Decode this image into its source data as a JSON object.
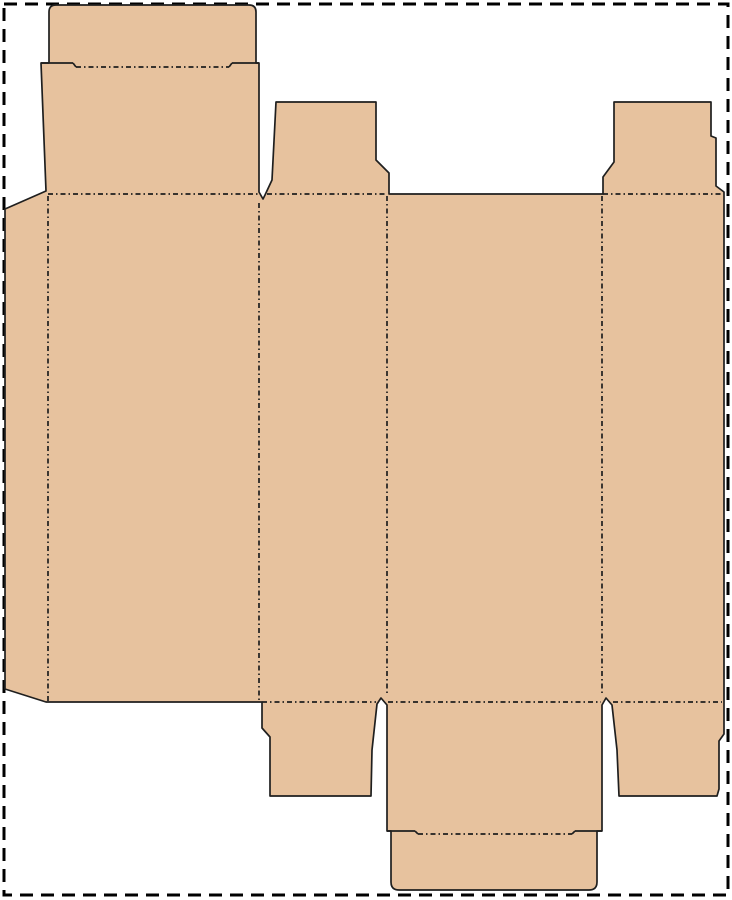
{
  "page": {
    "width": 732,
    "height": 900,
    "background": "#ffffff"
  },
  "diagram": {
    "type": "packaging-dieline",
    "description": "Flat die-cut template (dieline) of a reverse tuck-end carton: four body panels with glue flap, top lid with tuck flap, bottom lid with tuck flap, and four dust flaps",
    "colors": {
      "board_fill": "#e7c29e",
      "cut_line": "#1f1f1f",
      "fold_line": "#1f1f1f",
      "page_border": "#000000"
    },
    "line_styles": {
      "cut_width": 1.7,
      "fold_width": 1.7,
      "fold_dash": "5 3 1.5 3",
      "border_width": 3,
      "border_dash": "13 8"
    },
    "shapes": [
      {
        "name": "page-border",
        "tag": "rect",
        "attrs": {
          "x": 4,
          "y": 4,
          "width": 724,
          "height": 891,
          "fill": "none",
          "stroke": "#000000",
          "stroke-width": 3,
          "stroke-dasharray": "13 8"
        }
      },
      {
        "name": "carton-outline",
        "tag": "path",
        "attrs": {
          "d": "M 49 12 Q 49 5 56 5 L 249 5 Q 256 5 256 12 L 256 63 L 259 63 L 259 192 L 263 199 L 265 195 L 272 180 L 276 102 L 376 102 L 376 160 L 389 173 L 389 194 L 602 194 L 603 194 L 603 177 L 614 162 L 614 102 L 711 102 L 711 136 L 716 138 L 716 186 L 724 192 L 724 734 L 719 741 L 719 789 L 717 796 L 619 796 L 617 750 L 612 705 L 606 698 L 602 705 L 602 831 L 597 831 L 597 882 Q 597 890 589 890 L 399 890 Q 391 890 391 882 L 391 831 L 387 831 L 387 705 L 381 698 L 377 704 L 372 750 L 371 796 L 270 796 L 270 737 L 262 728 L 262 702 L 46 702 L 5 689 L 5 209 L 46 191 L 41 63 L 49 63 Z",
          "fill": "#e7c29e",
          "stroke": "#1f1f1f",
          "stroke-width": 1.7,
          "stroke-linejoin": "round"
        }
      },
      {
        "name": "fold-tuck-top",
        "tag": "line",
        "attrs": {
          "x1": 76,
          "y1": 67,
          "x2": 229,
          "y2": 67,
          "stroke": "#1f1f1f",
          "stroke-width": 1.7,
          "stroke-dasharray": "5 3 1.5 3"
        }
      },
      {
        "name": "fold-lid-top",
        "tag": "line",
        "attrs": {
          "x1": 48,
          "y1": 194,
          "x2": 258,
          "y2": 194,
          "stroke": "#1f1f1f",
          "stroke-width": 1.7,
          "stroke-dasharray": "5 3 1.5 3"
        }
      },
      {
        "name": "fold-dustflap-top-left",
        "tag": "line",
        "attrs": {
          "x1": 267,
          "y1": 194,
          "x2": 387,
          "y2": 194,
          "stroke": "#1f1f1f",
          "stroke-width": 1.7,
          "stroke-dasharray": "5 3 1.5 3"
        }
      },
      {
        "name": "fold-dustflap-top-right",
        "tag": "line",
        "attrs": {
          "x1": 603,
          "y1": 194,
          "x2": 722,
          "y2": 194,
          "stroke": "#1f1f1f",
          "stroke-width": 1.7,
          "stroke-dasharray": "5 3 1.5 3"
        }
      },
      {
        "name": "fold-glue-flap",
        "tag": "line",
        "attrs": {
          "x1": 48,
          "y1": 196,
          "x2": 48,
          "y2": 701,
          "stroke": "#1f1f1f",
          "stroke-width": 1.7,
          "stroke-dasharray": "5 3 1.5 3"
        }
      },
      {
        "name": "fold-panel-1-2",
        "tag": "line",
        "attrs": {
          "x1": 259,
          "y1": 203,
          "x2": 259,
          "y2": 701,
          "stroke": "#1f1f1f",
          "stroke-width": 1.7,
          "stroke-dasharray": "5 3 1.5 3"
        }
      },
      {
        "name": "fold-panel-2-3",
        "tag": "line",
        "attrs": {
          "x1": 387,
          "y1": 196,
          "x2": 387,
          "y2": 696,
          "stroke": "#1f1f1f",
          "stroke-width": 1.7,
          "stroke-dasharray": "5 3 1.5 3"
        }
      },
      {
        "name": "fold-panel-3-4",
        "tag": "line",
        "attrs": {
          "x1": 602,
          "y1": 196,
          "x2": 602,
          "y2": 696,
          "stroke": "#1f1f1f",
          "stroke-width": 1.7,
          "stroke-dasharray": "5 3 1.5 3"
        }
      },
      {
        "name": "fold-dustflap-bottom-left",
        "tag": "line",
        "attrs": {
          "x1": 262,
          "y1": 702,
          "x2": 376,
          "y2": 702,
          "stroke": "#1f1f1f",
          "stroke-width": 1.7,
          "stroke-dasharray": "5 3 1.5 3"
        }
      },
      {
        "name": "fold-lid-bottom",
        "tag": "line",
        "attrs": {
          "x1": 388,
          "y1": 702,
          "x2": 601,
          "y2": 702,
          "stroke": "#1f1f1f",
          "stroke-width": 1.7,
          "stroke-dasharray": "5 3 1.5 3"
        }
      },
      {
        "name": "fold-dustflap-bottom-right",
        "tag": "line",
        "attrs": {
          "x1": 613,
          "y1": 702,
          "x2": 722,
          "y2": 702,
          "stroke": "#1f1f1f",
          "stroke-width": 1.7,
          "stroke-dasharray": "5 3 1.5 3"
        }
      },
      {
        "name": "fold-tuck-bottom",
        "tag": "line",
        "attrs": {
          "x1": 418,
          "y1": 834,
          "x2": 572,
          "y2": 834,
          "stroke": "#1f1f1f",
          "stroke-width": 1.7,
          "stroke-dasharray": "5 3 1.5 3"
        }
      },
      {
        "name": "cut-shoulder-top-left",
        "tag": "line",
        "attrs": {
          "x1": 41,
          "y1": 63,
          "x2": 73,
          "y2": 63,
          "stroke": "#1f1f1f",
          "stroke-width": 1.7
        }
      },
      {
        "name": "cut-hook-top-left",
        "tag": "line",
        "attrs": {
          "x1": 73,
          "y1": 63,
          "x2": 76,
          "y2": 67,
          "stroke": "#1f1f1f",
          "stroke-width": 1.7
        }
      },
      {
        "name": "cut-shoulder-top-right",
        "tag": "line",
        "attrs": {
          "x1": 232,
          "y1": 63,
          "x2": 259,
          "y2": 63,
          "stroke": "#1f1f1f",
          "stroke-width": 1.7
        }
      },
      {
        "name": "cut-hook-top-right",
        "tag": "line",
        "attrs": {
          "x1": 229,
          "y1": 67,
          "x2": 232,
          "y2": 63,
          "stroke": "#1f1f1f",
          "stroke-width": 1.7
        }
      },
      {
        "name": "cut-shoulder-bottom-left",
        "tag": "line",
        "attrs": {
          "x1": 387,
          "y1": 831,
          "x2": 415,
          "y2": 831,
          "stroke": "#1f1f1f",
          "stroke-width": 1.7
        }
      },
      {
        "name": "cut-hook-bottom-left",
        "tag": "line",
        "attrs": {
          "x1": 415,
          "y1": 831,
          "x2": 418,
          "y2": 834,
          "stroke": "#1f1f1f",
          "stroke-width": 1.7
        }
      },
      {
        "name": "cut-shoulder-bottom-right",
        "tag": "line",
        "attrs": {
          "x1": 575,
          "y1": 831,
          "x2": 602,
          "y2": 831,
          "stroke": "#1f1f1f",
          "stroke-width": 1.7
        }
      },
      {
        "name": "cut-hook-bottom-right",
        "tag": "line",
        "attrs": {
          "x1": 572,
          "y1": 834,
          "x2": 575,
          "y2": 831,
          "stroke": "#1f1f1f",
          "stroke-width": 1.7
        }
      }
    ]
  }
}
